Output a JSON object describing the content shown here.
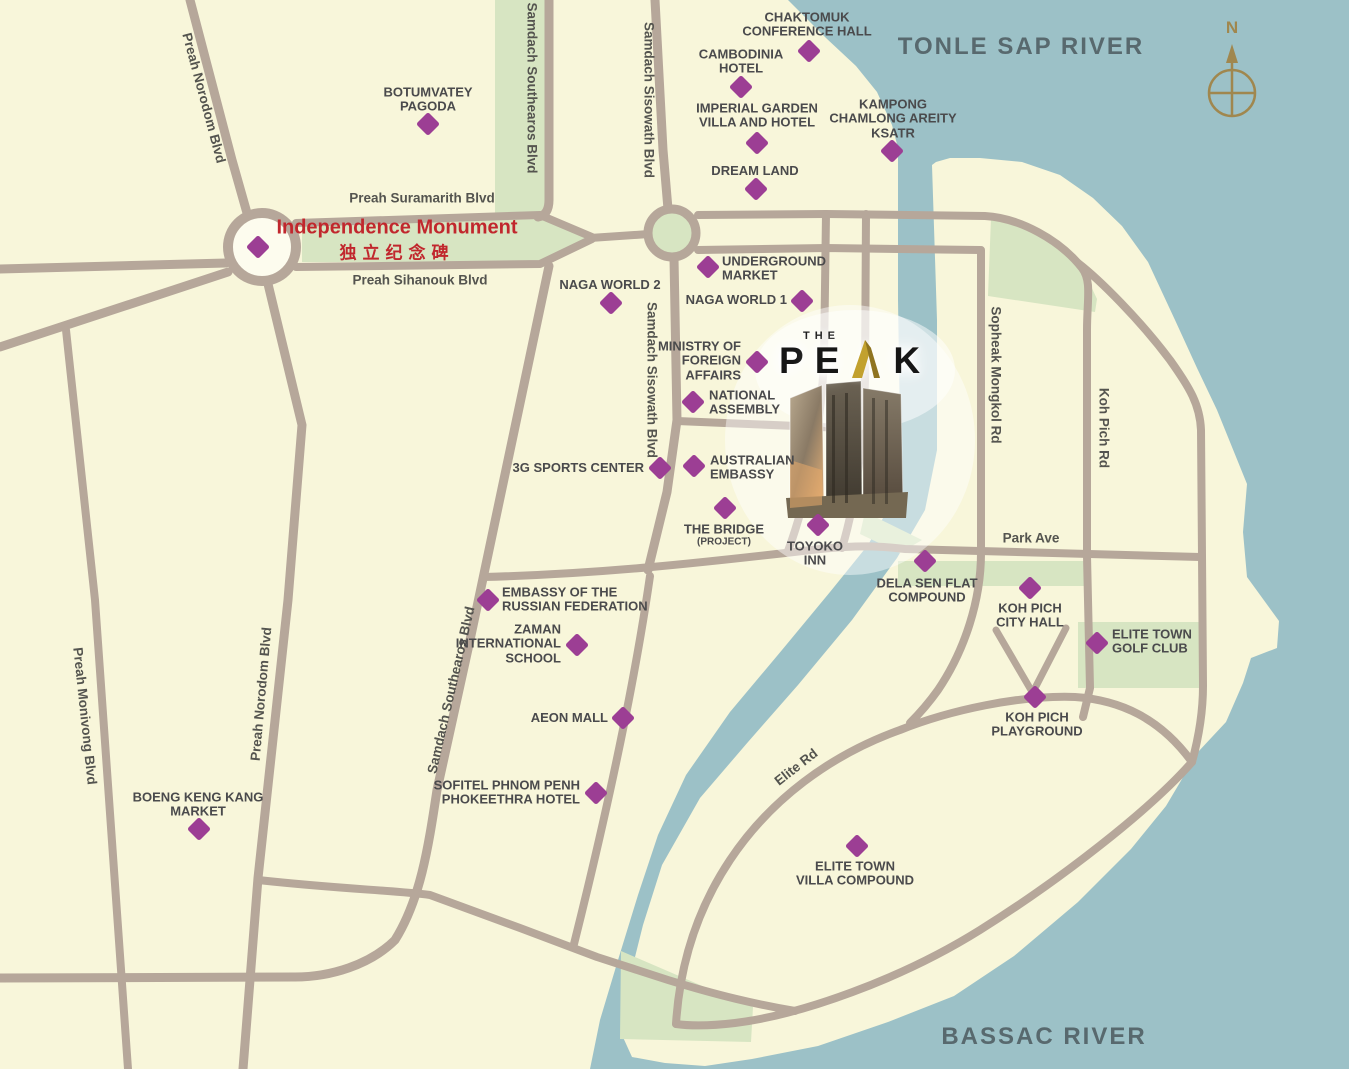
{
  "colors": {
    "land": "#f8f6da",
    "water": "#9cc1c7",
    "road": "#b6a79a",
    "green": "#d7e5c2",
    "marker": "#9c3e94",
    "label_text": "#4a4a4c",
    "river_text": "#58696e",
    "monument_red": "#c1272d",
    "compass_gold": "#a0874e",
    "logo_black": "#161616",
    "logo_gold": "#b5952f"
  },
  "rivers": [
    {
      "name": "TONLE SAP RIVER",
      "x": 1021,
      "y": 47
    },
    {
      "name": "BASSAC RIVER",
      "x": 1044,
      "y": 1037
    }
  ],
  "monument": {
    "name_en": "Independence Monument",
    "name_cn": "独立纪念碑",
    "x": 258,
    "y": 247,
    "lx": 397,
    "ly": 240
  },
  "compass": {
    "label": "N"
  },
  "logo": {
    "the": "THE",
    "p": "P",
    "e": "E",
    "k": "K"
  },
  "road_labels": [
    {
      "text": "Preah Suramarith Blvd",
      "x": 422,
      "y": 198,
      "rot": 0
    },
    {
      "text": "Preah Sihanouk Blvd",
      "x": 420,
      "y": 280,
      "rot": 0
    },
    {
      "text": "Preah Norodom Blvd",
      "x": 204,
      "y": 98,
      "rot": 75
    },
    {
      "text": "Preah Norodom Blvd",
      "x": 261,
      "y": 694,
      "rot": -85
    },
    {
      "text": "Preah Monivong Blvd",
      "x": 85,
      "y": 716,
      "rot": 84
    },
    {
      "text": "Samdach Southearos Blvd",
      "x": 532,
      "y": 88,
      "rot": 90
    },
    {
      "text": "Samdach Southearos Blvd",
      "x": 451,
      "y": 690,
      "rot": -77
    },
    {
      "text": "Samdach Sisowath Blvd",
      "x": 649,
      "y": 100,
      "rot": 90
    },
    {
      "text": "Samdach Sisowath Blvd",
      "x": 652,
      "y": 380,
      "rot": 90
    },
    {
      "text": "Sopheak Mongkol Rd",
      "x": 996,
      "y": 375,
      "rot": 90
    },
    {
      "text": "Koh Pich Rd",
      "x": 1104,
      "y": 428,
      "rot": 90
    },
    {
      "text": "Park Ave",
      "x": 1031,
      "y": 538,
      "rot": 0
    },
    {
      "text": "Elite Rd",
      "x": 796,
      "y": 767,
      "rot": -38
    }
  ],
  "pois": [
    {
      "id": "chaktomuk-conference-hall",
      "label": [
        "CHAKTOMUK",
        "CONFERENCE HALL"
      ],
      "x": 809,
      "y": 51,
      "lx": 807,
      "ly": 25,
      "align": "center"
    },
    {
      "id": "cambodinia-hotel",
      "label": [
        "CAMBODINIA",
        "HOTEL"
      ],
      "x": 741,
      "y": 87,
      "lx": 741,
      "ly": 62,
      "align": "center"
    },
    {
      "id": "imperial-garden-villa-and-hotel",
      "label": [
        "IMPERIAL GARDEN",
        "VILLA AND HOTEL"
      ],
      "x": 757,
      "y": 143,
      "lx": 757,
      "ly": 116,
      "align": "center"
    },
    {
      "id": "kampong-chamlong-areity-ksatr",
      "label": [
        "KAMPONG",
        "CHAMLONG AREITY",
        "KSATR"
      ],
      "x": 892,
      "y": 151,
      "lx": 893,
      "ly": 119,
      "align": "center"
    },
    {
      "id": "dream-land",
      "label": [
        "DREAM LAND"
      ],
      "x": 756,
      "y": 189,
      "lx": 755,
      "ly": 171,
      "align": "center"
    },
    {
      "id": "botumvatey-pagoda",
      "label": [
        "BOTUMVATEY",
        "PAGODA"
      ],
      "x": 428,
      "y": 124,
      "lx": 428,
      "ly": 100,
      "align": "center"
    },
    {
      "id": "naga-world-2",
      "label": [
        "NAGA WORLD 2"
      ],
      "x": 611,
      "y": 303,
      "lx": 610,
      "ly": 285,
      "align": "center"
    },
    {
      "id": "underground-market",
      "label": [
        "UNDERGROUND",
        "MARKET"
      ],
      "x": 708,
      "y": 267,
      "lx": 722,
      "ly": 269,
      "align": "left"
    },
    {
      "id": "naga-world-1",
      "label": [
        "NAGA WORLD 1"
      ],
      "x": 802,
      "y": 301,
      "lx": 787,
      "ly": 300,
      "align": "right"
    },
    {
      "id": "ministry-of-foreign-affairs",
      "label": [
        "MINISTRY OF",
        "FOREIGN",
        "AFFAIRS"
      ],
      "x": 757,
      "y": 362,
      "lx": 741,
      "ly": 361,
      "align": "right"
    },
    {
      "id": "national-assembly",
      "label": [
        "NATIONAL",
        "ASSEMBLY"
      ],
      "x": 693,
      "y": 402,
      "lx": 709,
      "ly": 403,
      "align": "left"
    },
    {
      "id": "3g-sports-center",
      "label": [
        "3G SPORTS CENTER"
      ],
      "x": 660,
      "y": 468,
      "lx": 644,
      "ly": 468,
      "align": "right"
    },
    {
      "id": "australian-embassy",
      "label": [
        "AUSTRALIAN",
        "EMBASSY"
      ],
      "x": 694,
      "y": 466,
      "lx": 710,
      "ly": 468,
      "align": "left"
    },
    {
      "id": "the-bridge-project",
      "label": [
        "THE BRIDGE",
        "(PROJECT)"
      ],
      "x": 725,
      "y": 508,
      "lx": 724,
      "ly": 535,
      "align": "center"
    },
    {
      "id": "toyoko-inn",
      "label": [
        "TOYOKO",
        "INN"
      ],
      "x": 818,
      "y": 525,
      "lx": 815,
      "ly": 554,
      "align": "center"
    },
    {
      "id": "dela-sen-flat-compound",
      "label": [
        "DELA SEN FLAT",
        "COMPOUND"
      ],
      "x": 925,
      "y": 561,
      "lx": 927,
      "ly": 591,
      "align": "center"
    },
    {
      "id": "koh-pich-city-hall",
      "label": [
        "KOH PICH",
        "CITY HALL"
      ],
      "x": 1030,
      "y": 588,
      "lx": 1030,
      "ly": 616,
      "align": "center"
    },
    {
      "id": "elite-town-golf-club",
      "label": [
        "ELITE TOWN",
        "GOLF CLUB"
      ],
      "x": 1097,
      "y": 643,
      "lx": 1112,
      "ly": 642,
      "align": "left"
    },
    {
      "id": "koh-pich-playground",
      "label": [
        "KOH PICH",
        "PLAYGROUND"
      ],
      "x": 1035,
      "y": 697,
      "lx": 1037,
      "ly": 725,
      "align": "center"
    },
    {
      "id": "embassy-of-the-russian-federation",
      "label": [
        "EMBASSY OF THE",
        "RUSSIAN FEDERATION"
      ],
      "x": 488,
      "y": 600,
      "lx": 502,
      "ly": 600,
      "align": "left"
    },
    {
      "id": "zaman-international-school",
      "label": [
        "ZAMAN",
        "INTERNATIONAL",
        "SCHOOL"
      ],
      "x": 577,
      "y": 645,
      "lx": 561,
      "ly": 644,
      "align": "right"
    },
    {
      "id": "aeon-mall",
      "label": [
        "AEON MALL"
      ],
      "x": 623,
      "y": 718,
      "lx": 608,
      "ly": 718,
      "align": "right"
    },
    {
      "id": "sofitel-phnom-penh-phokeethra-hotel",
      "label": [
        "SOFITEL PHNOM PENH",
        "PHOKEETHRA HOTEL"
      ],
      "x": 596,
      "y": 793,
      "lx": 580,
      "ly": 793,
      "align": "right"
    },
    {
      "id": "boeng-keng-kang-market",
      "label": [
        "BOENG KENG KANG",
        "MARKET"
      ],
      "x": 199,
      "y": 829,
      "lx": 198,
      "ly": 805,
      "align": "center"
    },
    {
      "id": "elite-town-villa-compound",
      "label": [
        "ELITE TOWN",
        "VILLA COMPOUND"
      ],
      "x": 857,
      "y": 846,
      "lx": 855,
      "ly": 874,
      "align": "center"
    }
  ]
}
